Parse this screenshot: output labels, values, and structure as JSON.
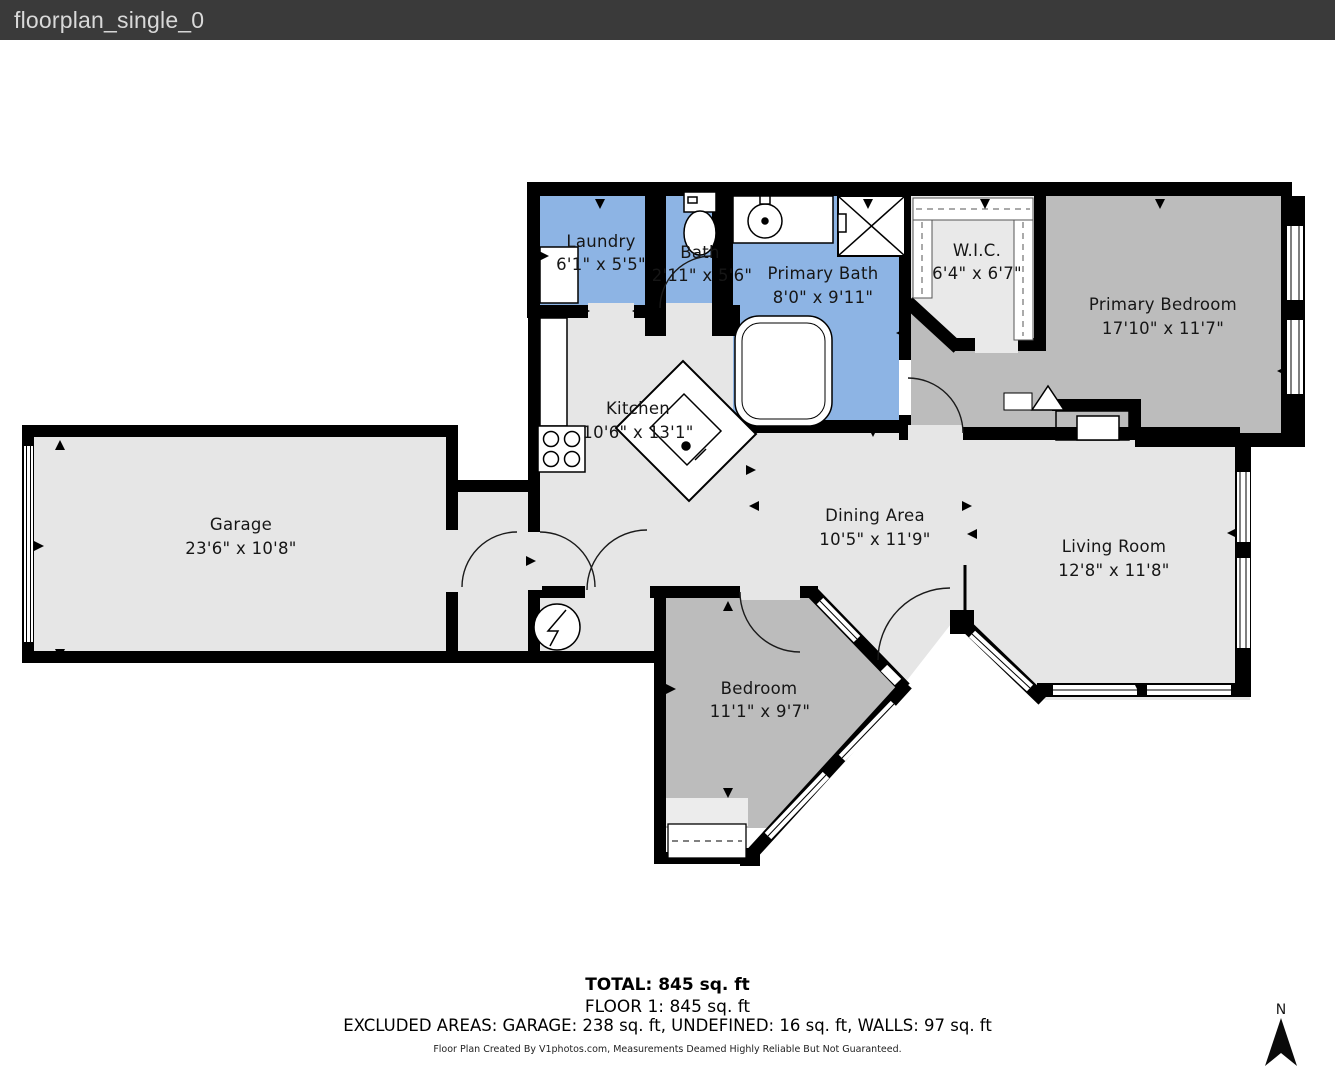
{
  "header": {
    "title": "floorplan_single_0"
  },
  "colors": {
    "titlebar_bg": "#3a3a3a",
    "titlebar_text": "#d9d9d9",
    "wall": "#000000",
    "room_blue": "#8db4e4",
    "room_dark_gray": "#bcbcbc",
    "room_light_gray": "#e6e6e6",
    "room_closet_gray": "#ebebeb",
    "background": "#ffffff"
  },
  "rooms": [
    {
      "id": "laundry",
      "name": "Laundry",
      "dims": "6'1\" x 5'5\""
    },
    {
      "id": "bath",
      "name": "Bath",
      "dims": "2'11\" x 5'6\""
    },
    {
      "id": "primary_bath",
      "name": "Primary Bath",
      "dims": "8'0\" x 9'11\""
    },
    {
      "id": "wic",
      "name": "W.I.C.",
      "dims": "6'4\" x 6'7\""
    },
    {
      "id": "primary_bedroom",
      "name": "Primary Bedroom",
      "dims": "17'10\" x 11'7\""
    },
    {
      "id": "kitchen",
      "name": "Kitchen",
      "dims": "10'6\" x 13'1\""
    },
    {
      "id": "garage",
      "name": "Garage",
      "dims": "23'6\" x 10'8\""
    },
    {
      "id": "dining_area",
      "name": "Dining Area",
      "dims": "10'5\" x 11'9\""
    },
    {
      "id": "living_room",
      "name": "Living Room",
      "dims": "12'8\" x 11'8\""
    },
    {
      "id": "bedroom",
      "name": "Bedroom",
      "dims": "11'1\" x 9'7\""
    }
  ],
  "summary": {
    "total": "TOTAL: 845 sq. ft",
    "floor1": "FLOOR 1: 845 sq. ft",
    "excluded": "EXCLUDED AREAS: GARAGE: 238 sq. ft, UNDEFINED: 16 sq. ft, WALLS: 97 sq. ft",
    "credit": "Floor Plan Created By V1photos.com, Measurements Deamed Highly Reliable But Not Guaranteed."
  },
  "compass": {
    "label": "N"
  }
}
